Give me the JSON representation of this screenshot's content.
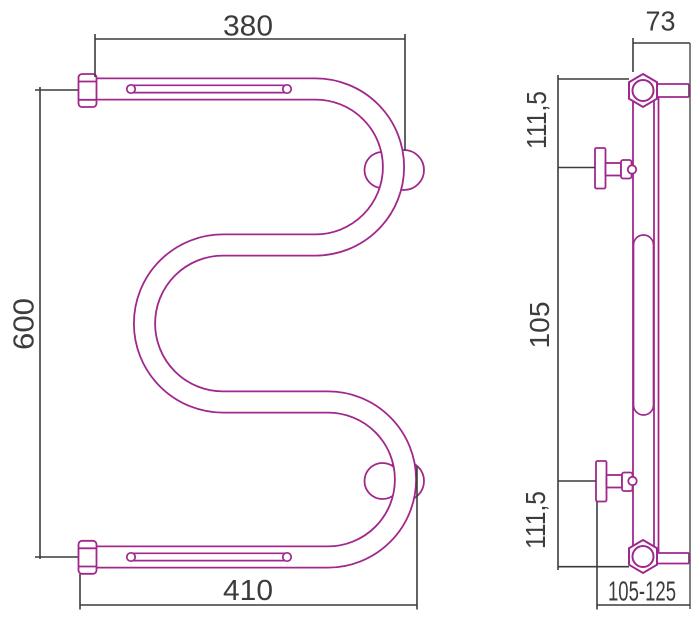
{
  "drawing": {
    "title": "towel-rail-dimension-drawing",
    "front_view": {
      "dim_width_top": "380",
      "dim_height": "600",
      "dim_width_bottom": "410"
    },
    "side_view": {
      "dim_depth_top": "73",
      "dim_top_to_bracket": "111,5",
      "dim_between_brackets": "105",
      "dim_bracket_to_bottom": "111,5",
      "dim_mount_range": "105-125"
    },
    "colors": {
      "outline": "#A0288C",
      "dimension": "#3C3C3C",
      "background": "#FFFFFF"
    }
  }
}
